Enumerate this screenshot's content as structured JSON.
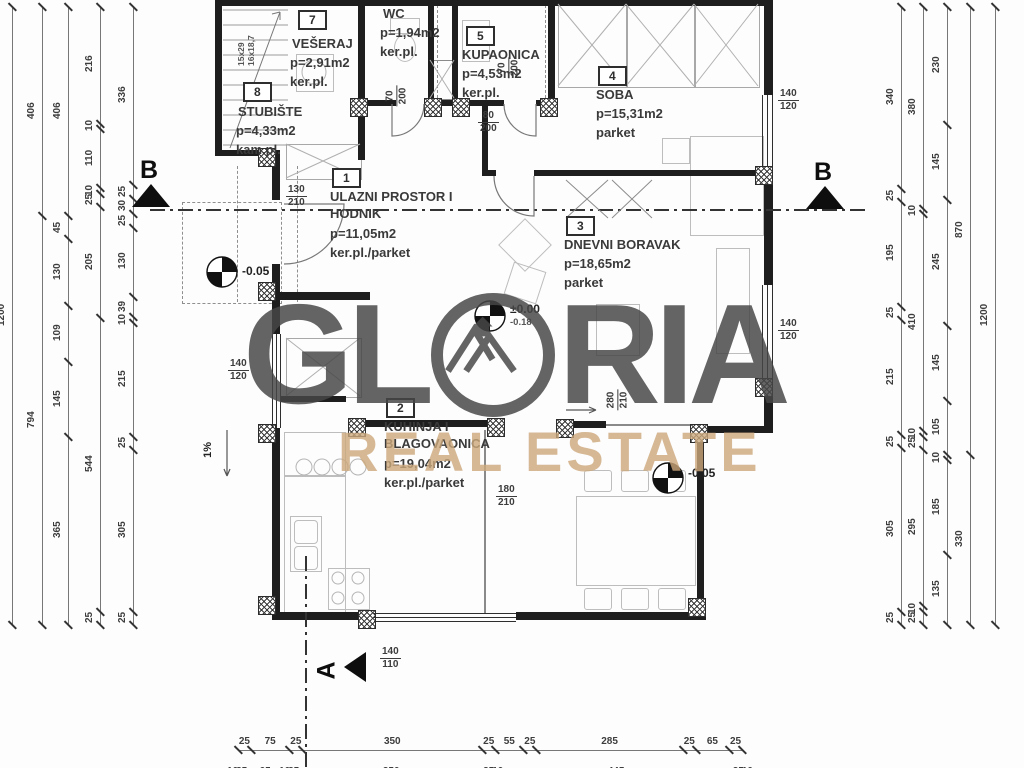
{
  "watermark": {
    "left": "GL",
    "right": "RIA",
    "subtitle": "REAL ESTATE",
    "accent_dark": "#474747",
    "accent_tan": "#cda87c"
  },
  "rooms": [
    {
      "number": "1",
      "name": "ULAZNI PROSTOR I\nHODNIK",
      "area": "p=11,05m2",
      "floor": "ker.pl./parket"
    },
    {
      "number": "2",
      "name": "KUHINJA I\nBLAGOVAONICA",
      "area": "p=19,04m2",
      "floor": "ker.pl./parket"
    },
    {
      "number": "3",
      "name": "DNEVNI BORAVAK",
      "area": "p=18,65m2",
      "floor": "parket"
    },
    {
      "number": "4",
      "name": "SOBA",
      "area": "p=15,31m2",
      "floor": "parket"
    },
    {
      "number": "5",
      "name": "KUPAONICA",
      "area": "p=4,53m2",
      "floor": "ker.pl."
    },
    {
      "number": "",
      "name": "WC",
      "area": "p=1,94m2",
      "floor": "ker.pl."
    },
    {
      "number": "7",
      "name": "VEŠERAJ",
      "area": "p=2,91m2",
      "floor": "ker.pl."
    },
    {
      "number": "8",
      "name": "STUBIŠTE",
      "area": "p=4,33m2",
      "floor": "kam.pl."
    }
  ],
  "openings": {
    "entry_door": {
      "w": "130",
      "h": "210"
    },
    "wc_door": {
      "w": "70",
      "h": "200"
    },
    "bath_door": {
      "w": "70",
      "h": "200"
    },
    "soba_door": {
      "w": "80",
      "h": "200"
    },
    "kitchen_door": {
      "w": "180",
      "h": "210"
    },
    "living_slider": {
      "w": "280",
      "h": "210"
    },
    "win_right_top": {
      "w": "140",
      "h": "120"
    },
    "win_right_mid": {
      "w": "140",
      "h": "120"
    },
    "win_left": {
      "w": "140",
      "h": "120"
    },
    "win_bottom": {
      "w": "140",
      "h": "110"
    }
  },
  "levels": {
    "entry_main": "±0.00",
    "entry_sub": "-0.18",
    "left": "-0.05",
    "dining": "-0.05"
  },
  "misc": {
    "slope": "1%",
    "stair_dims": "15x29\n16x18,7",
    "section_b": "B",
    "section_a": "A"
  },
  "dimensions": {
    "left": [
      [
        "1200"
      ],
      [
        "406",
        "794"
      ],
      [
        "406",
        "45",
        "130",
        "109",
        "145",
        "365"
      ],
      [
        "216",
        "10",
        "110",
        "10",
        "25",
        "205",
        "544",
        "25"
      ],
      [
        "336",
        "25",
        "30",
        "25",
        "130",
        "39",
        "10",
        "215",
        "25",
        "305",
        "25"
      ]
    ],
    "right": [
      [
        "340",
        "25",
        "195",
        "25",
        "215",
        "25",
        "305",
        "25"
      ],
      [
        "380",
        "10",
        "410",
        "10",
        "25",
        "295",
        "10",
        "25"
      ],
      [
        "230",
        "145",
        "245",
        "145",
        "105",
        "10",
        "185",
        "135"
      ],
      [
        "870",
        "330"
      ],
      [
        "1200"
      ]
    ],
    "bottom": [
      [
        "25",
        "75",
        "25",
        "350",
        "25",
        "55",
        "25",
        "285",
        "25",
        "65",
        "25"
      ],
      [
        "10",
        "25",
        "65",
        "10",
        "25",
        "350",
        "25",
        "10",
        "445",
        "25",
        "10"
      ]
    ]
  }
}
